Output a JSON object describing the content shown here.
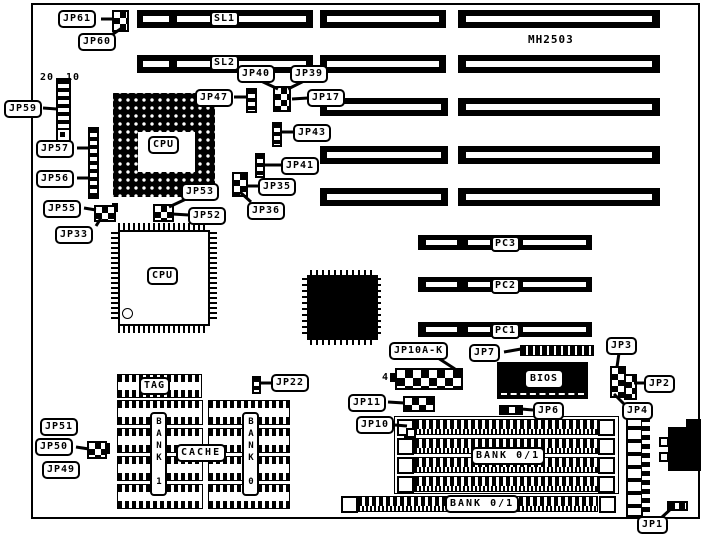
{
  "board": {
    "model": "MH2503",
    "slots": {
      "sl1": "SL1",
      "sl2": "SL2",
      "pc1": "PC1",
      "pc2": "PC2",
      "pc3": "PC3"
    },
    "chips": {
      "cpu_socket": "CPU",
      "cpu_qfp": "CPU",
      "bios": "BIOS",
      "tag": "TAG",
      "cache": "CACHE",
      "cache_bank1": "BANK 1",
      "cache_bank0": "BANK 0",
      "simm_bank_upper": "BANK 0/1",
      "simm_bank_lower": "BANK 0/1"
    },
    "jumpers": {
      "jp1": "JP1",
      "jp2": "JP2",
      "jp3": "JP3",
      "jp4": "JP4",
      "jp6": "JP6",
      "jp7": "JP7",
      "jp10": "JP10",
      "jp10ak": "JP10A-K",
      "jp11": "JP11",
      "jp17": "JP17",
      "jp22": "JP22",
      "jp33": "JP33",
      "jp35": "JP35",
      "jp36": "JP36",
      "jp39": "JP39",
      "jp40": "JP40",
      "jp41": "JP41",
      "jp43": "JP43",
      "jp47": "JP47",
      "jp49": "JP49",
      "jp50": "JP50",
      "jp51": "JP51",
      "jp52": "JP52",
      "jp53": "JP53",
      "jp55": "JP55",
      "jp56": "JP56",
      "jp57": "JP57",
      "jp59": "JP59",
      "jp60": "JP60",
      "jp61": "JP61"
    },
    "annotations": {
      "jp59_pin20": "20",
      "jp59_pin10": "10",
      "jp10ak_pin4": "4"
    },
    "colors": {
      "ink": "#000000",
      "background": "#ffffff"
    }
  }
}
